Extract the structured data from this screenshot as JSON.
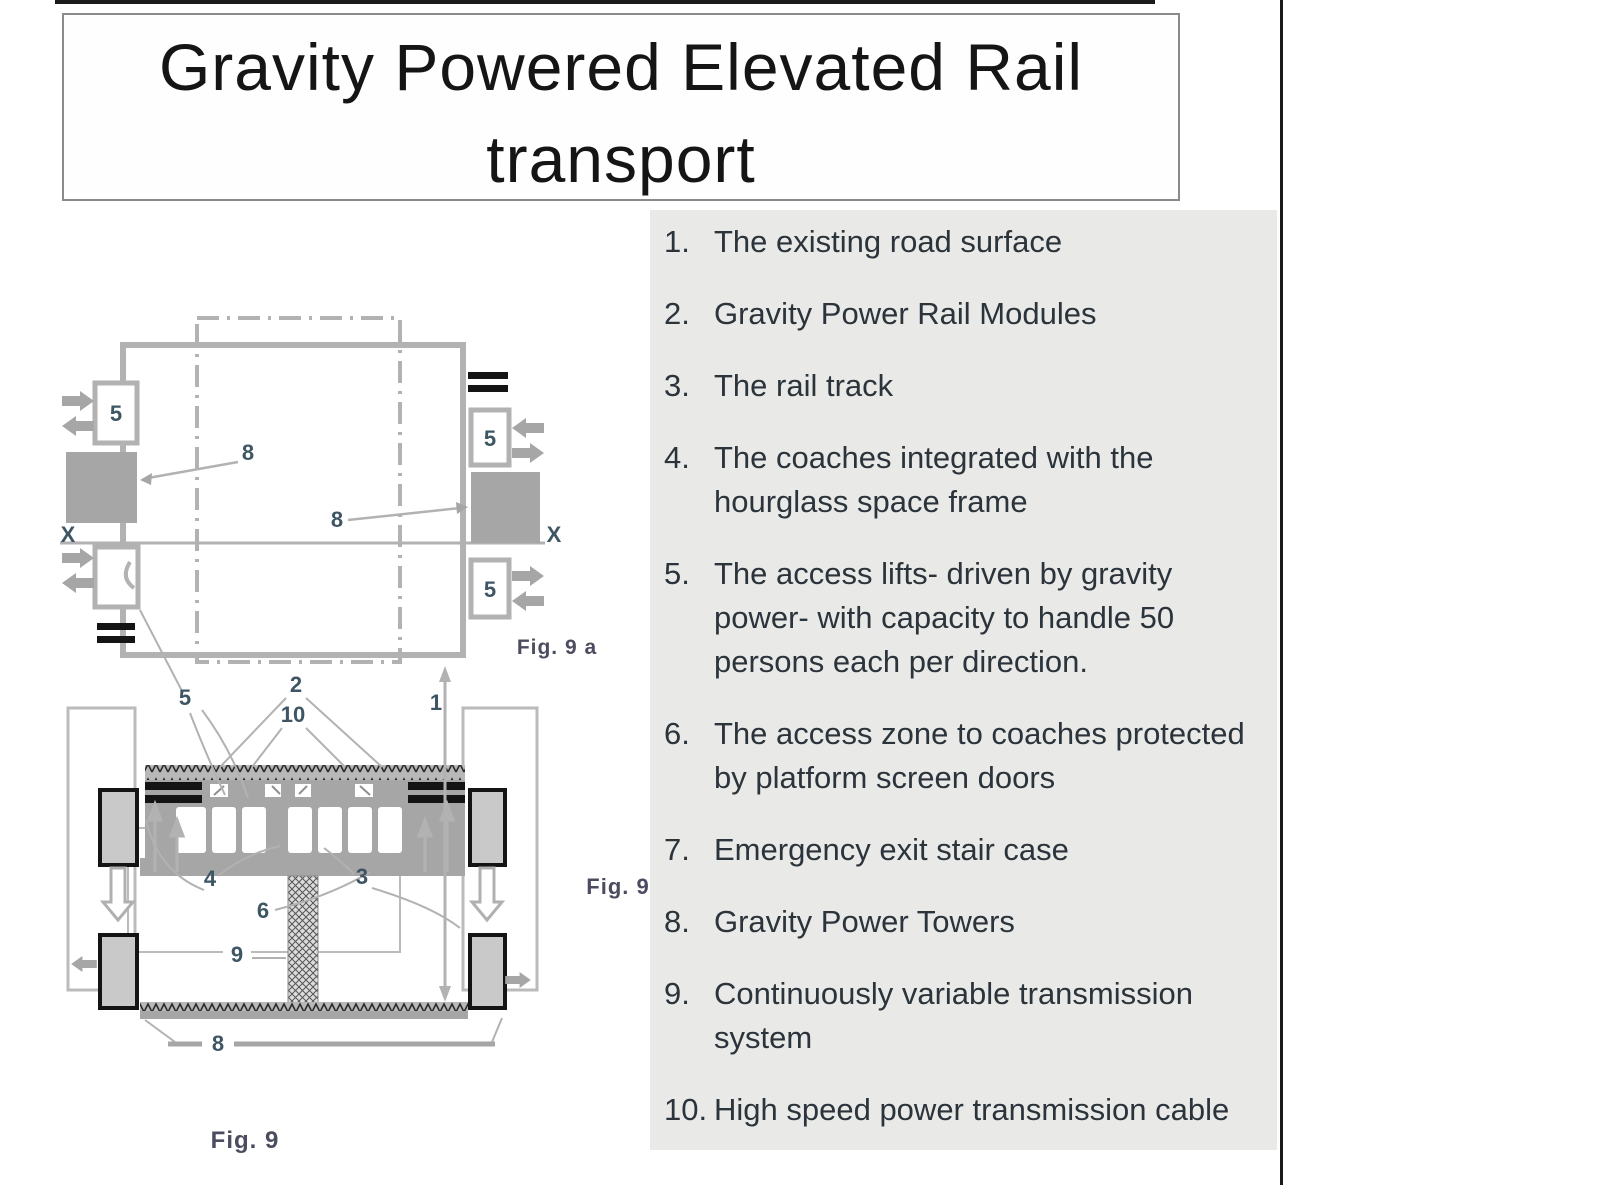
{
  "page": {
    "title_line1": "Gravity Powered Elevated Rail",
    "title_line2": "transport"
  },
  "legend": {
    "items": [
      {
        "num": "1.",
        "text": "The existing road surface"
      },
      {
        "num": "2.",
        "text": "Gravity Power Rail Modules"
      },
      {
        "num": "3.",
        "text": "The rail track"
      },
      {
        "num": "4.",
        "text": "The coaches integrated with the hourglass space frame"
      },
      {
        "num": "5.",
        "text": "The access lifts- driven by gravity power- with capacity to handle 50 persons each per direction."
      },
      {
        "num": "6.",
        "text": "The access zone to coaches protected by platform screen doors"
      },
      {
        "num": "7.",
        "text": "Emergency exit stair case"
      },
      {
        "num": "8.",
        "text": "Gravity Power Towers"
      },
      {
        "num": "9.",
        "text": "Continuously variable transmission system"
      },
      {
        "num": "10.",
        "text": "High speed power transmission cable"
      }
    ]
  },
  "figures": {
    "fig9a": {
      "caption": "Fig. 9 a",
      "lift_label": "5",
      "tower_label": "8",
      "axis_label": "X"
    },
    "fig9": {
      "caption_side": "Fig. 9",
      "caption_bottom": "Fig. 9",
      "labels": {
        "road": "1",
        "modules": "2",
        "track": "3",
        "coaches": "4",
        "lift": "5",
        "access": "6",
        "towers": "8",
        "cvt": "9",
        "cable": "10"
      }
    }
  },
  "colors": {
    "page_bg": "#ffffff",
    "panel_bg": "#e9e9e7",
    "rule_dark": "#1a1a1a",
    "diagram_gray": "#a6a6a6",
    "diagram_line": "#b2b2b2",
    "lift_box_fill": "#c9c9c9",
    "label_color": "#3e5663",
    "caption_color": "#4c4c60",
    "text_color": "#2b333b"
  }
}
